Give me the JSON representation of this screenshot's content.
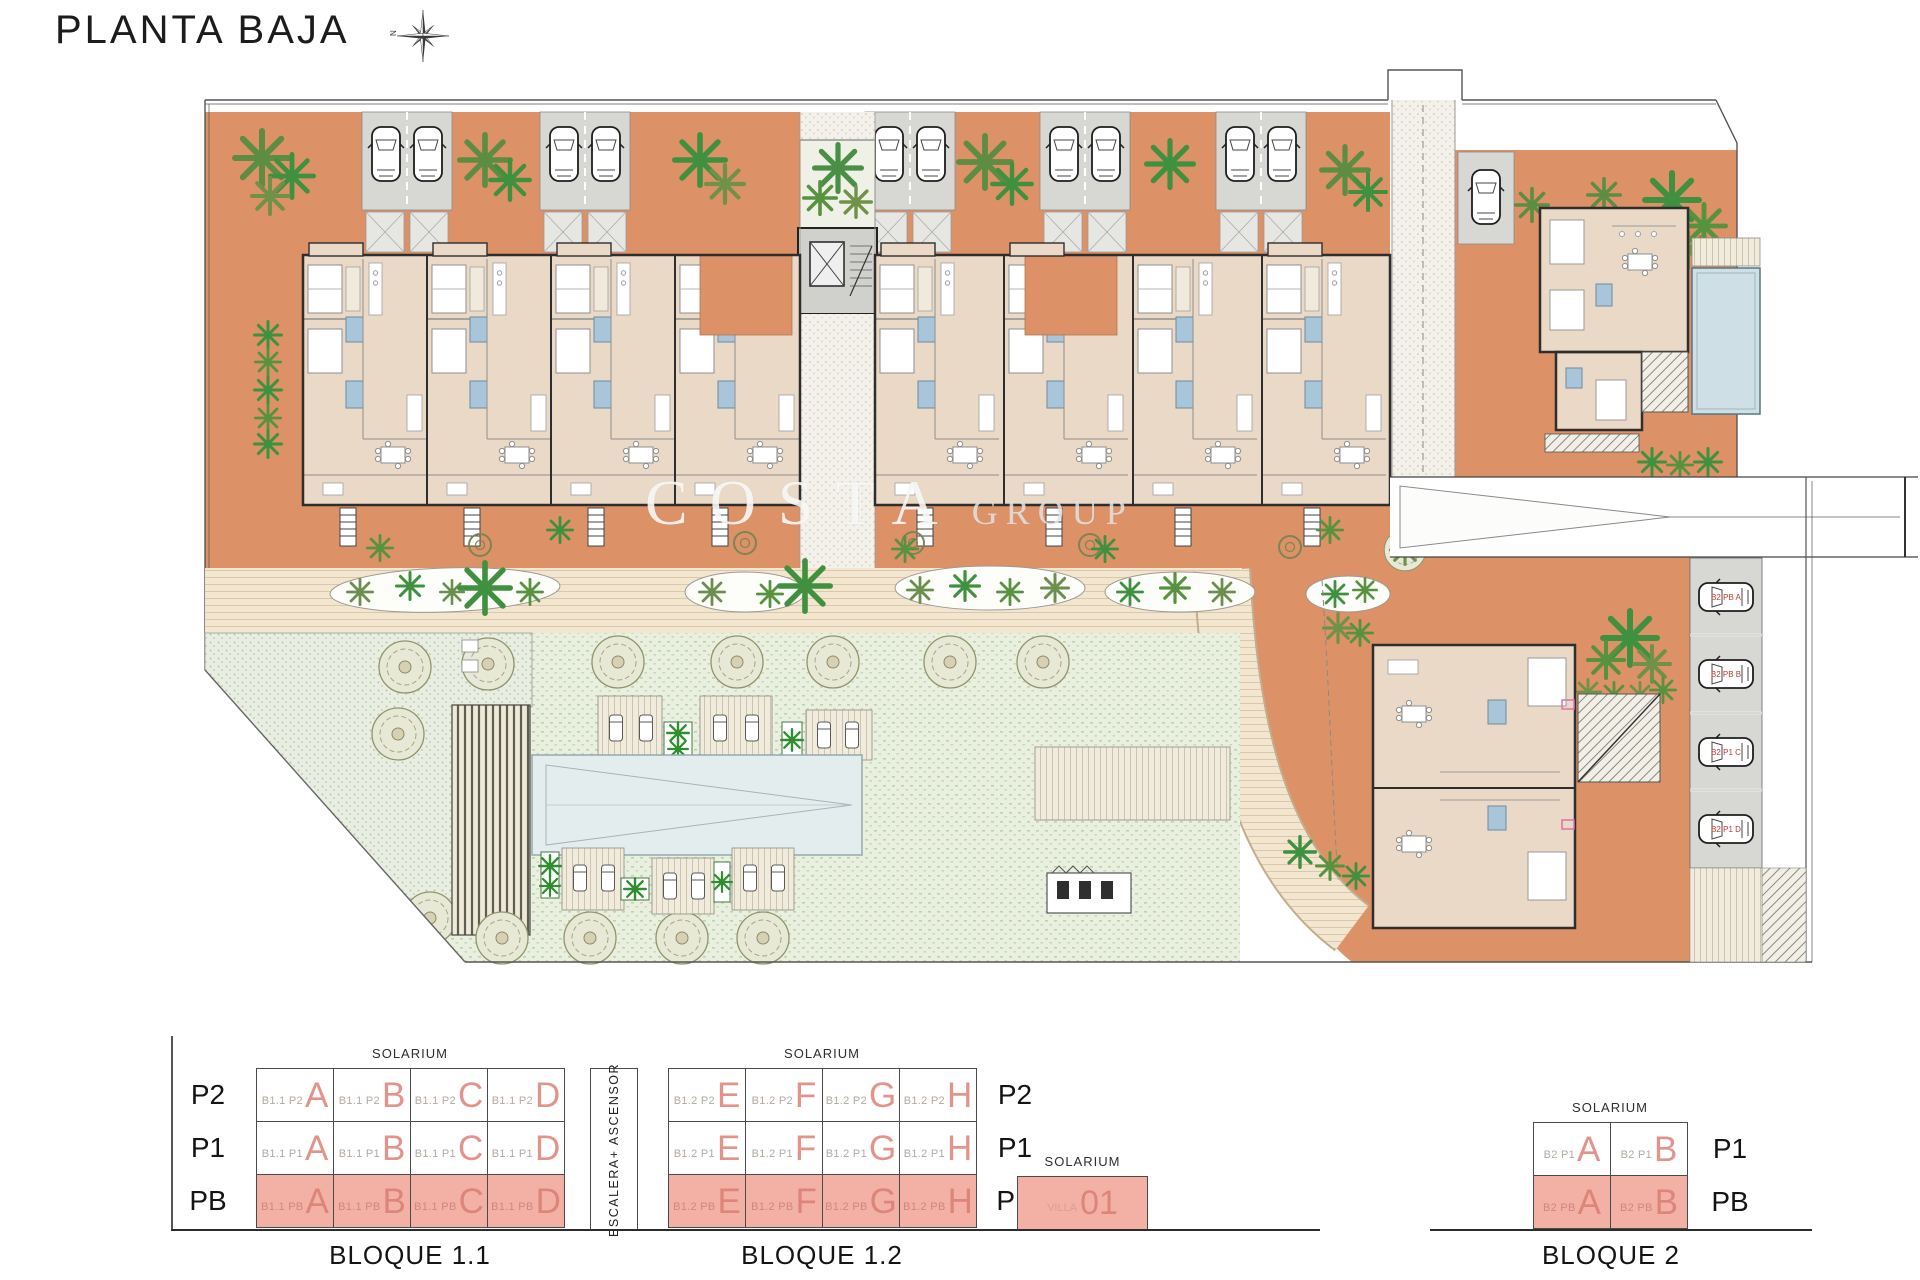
{
  "title": "PLANTA BAJA",
  "compass": {
    "north": "N"
  },
  "watermark": {
    "word1": "COSTA",
    "word2": "GROUP"
  },
  "site": {
    "parking_space_labels": [
      "B2 PB A",
      "B2 PB B",
      "B2 P1 C",
      "B2 P1 D"
    ]
  },
  "legend": {
    "solarium": "SOLARIUM",
    "escalera": "ESCALERA+ ASCENSOR",
    "bloque11": {
      "title": "BLOQUE 1.1",
      "row_labels": [
        "P2",
        "P1",
        "PB"
      ],
      "rows": [
        {
          "cells": [
            {
              "code": "B1.1 P2",
              "letter": "A"
            },
            {
              "code": "B1.1 P2",
              "letter": "B"
            },
            {
              "code": "B1.1 P2",
              "letter": "C"
            },
            {
              "code": "B1.1 P2",
              "letter": "D"
            }
          ]
        },
        {
          "cells": [
            {
              "code": "B1.1 P1",
              "letter": "A"
            },
            {
              "code": "B1.1 P1",
              "letter": "B"
            },
            {
              "code": "B1.1 P1",
              "letter": "C"
            },
            {
              "code": "B1.1 P1",
              "letter": "D"
            }
          ]
        },
        {
          "cells": [
            {
              "code": "B1.1 PB",
              "letter": "A"
            },
            {
              "code": "B1.1 PB",
              "letter": "B"
            },
            {
              "code": "B1.1 PB",
              "letter": "C"
            },
            {
              "code": "B1.1 PB",
              "letter": "D"
            }
          ]
        }
      ]
    },
    "bloque12": {
      "title": "BLOQUE 1.2",
      "row_labels": [
        "P2",
        "P1",
        "PB"
      ],
      "rows": [
        {
          "cells": [
            {
              "code": "B1.2 P2",
              "letter": "E"
            },
            {
              "code": "B1.2 P2",
              "letter": "F"
            },
            {
              "code": "B1.2 P2",
              "letter": "G"
            },
            {
              "code": "B1.2 P2",
              "letter": "H"
            }
          ]
        },
        {
          "cells": [
            {
              "code": "B1.2 P1",
              "letter": "E"
            },
            {
              "code": "B1.2 P1",
              "letter": "F"
            },
            {
              "code": "B1.2 P1",
              "letter": "G"
            },
            {
              "code": "B1.2 P1",
              "letter": "H"
            }
          ]
        },
        {
          "cells": [
            {
              "code": "B1.2 PB",
              "letter": "E"
            },
            {
              "code": "B1.2 PB",
              "letter": "F"
            },
            {
              "code": "B1.2 PB",
              "letter": "G"
            },
            {
              "code": "B1.2 PB",
              "letter": "H"
            }
          ]
        }
      ]
    },
    "villa": {
      "solarium": "SOLARIUM",
      "code": "VILLA",
      "number": "01"
    },
    "bloque2": {
      "title": "BLOQUE 2",
      "row_labels": [
        "P1",
        "PB"
      ],
      "rows": [
        {
          "cells": [
            {
              "code": "B2 P1",
              "letter": "A"
            },
            {
              "code": "B2 P1",
              "letter": "B"
            }
          ]
        },
        {
          "cells": [
            {
              "code": "B2 PB",
              "letter": "A"
            },
            {
              "code": "B2 PB",
              "letter": "B"
            }
          ]
        }
      ]
    }
  }
}
